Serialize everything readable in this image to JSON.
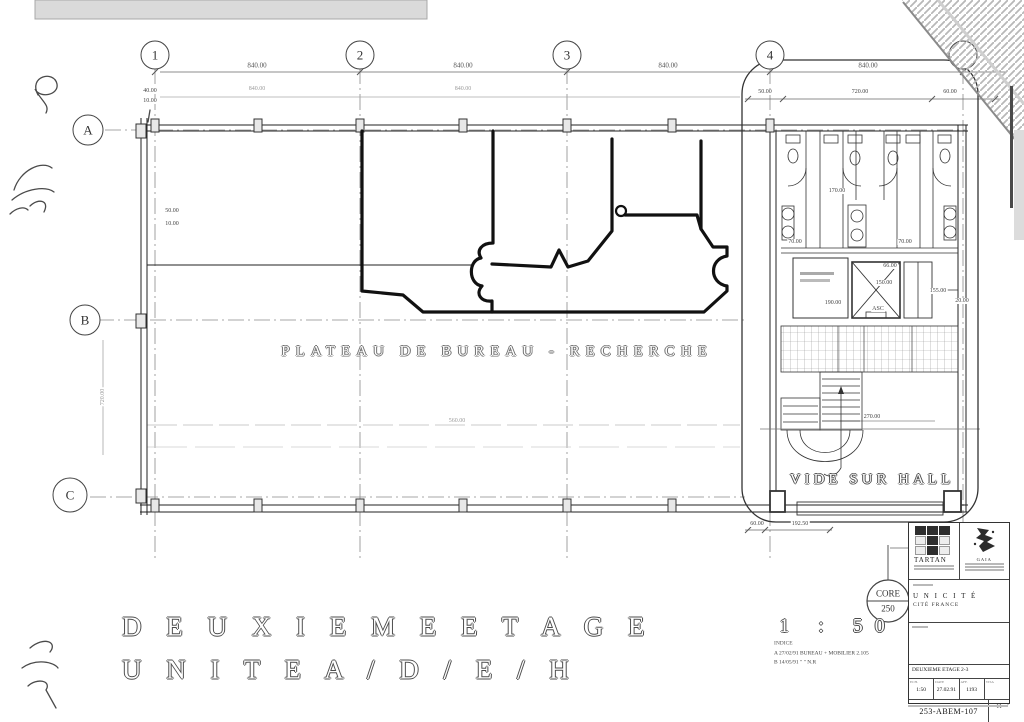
{
  "sheet": {
    "scale_text": "1 : 50",
    "title_line1": "D E U X I E M E     E T A G E",
    "title_line2": "U N I T E     A / D / E / H"
  },
  "plan": {
    "room_label": "PLATEAU DE BUREAU  -  RECHERCHE",
    "hall_label": "VIDE SUR HALL",
    "asc_label": "ASC",
    "core_bubble_top": "CORE",
    "core_bubble_bottom": "250"
  },
  "grid": {
    "cols": [
      "1",
      "2",
      "3",
      "4"
    ],
    "rows": [
      "A",
      "B",
      "C"
    ]
  },
  "dims": {
    "top": [
      "840.00",
      "840.00",
      "840.00",
      "840.00"
    ],
    "top2": [
      "840.00",
      "840.00"
    ],
    "core_top": [
      "50.00",
      "720.00",
      "60.00"
    ],
    "col1_small": [
      "40.00",
      "10.00"
    ],
    "left_small": [
      "50.00",
      "10.00"
    ],
    "left_vert": "720.00",
    "interior": "560.00",
    "elevator": {
      "a": "66.00",
      "b": "150.00",
      "c": "190.00",
      "d": "155.00",
      "e": "20.00"
    },
    "toilet": [
      "170.00",
      "70.00",
      "70.00"
    ],
    "stair": "270.00",
    "bottom": [
      "60.00",
      "192.50"
    ]
  },
  "revisions": {
    "heading": "INDICE",
    "row_a": "A  27/02/91   BUREAU + MOBILIER   2.105",
    "row_b": "B  14/05/91        \"              \"         N.R"
  },
  "titleblock": {
    "firm": "TARTAN",
    "partner": "GAIA",
    "project1": "U N I C I T É",
    "project2": "CITÉ  FRANCE",
    "drawing_title": "DEUXIEME ETAGE 2-3",
    "meta": [
      {
        "label": "ECH.",
        "value": "1:50"
      },
      {
        "label": "DATE",
        "value": "27.02.91"
      },
      {
        "label": "AFF.",
        "value": "1193"
      },
      {
        "label": "VISA",
        "value": ""
      }
    ],
    "number": "253-ABEM-107",
    "sheet_no": "11"
  }
}
